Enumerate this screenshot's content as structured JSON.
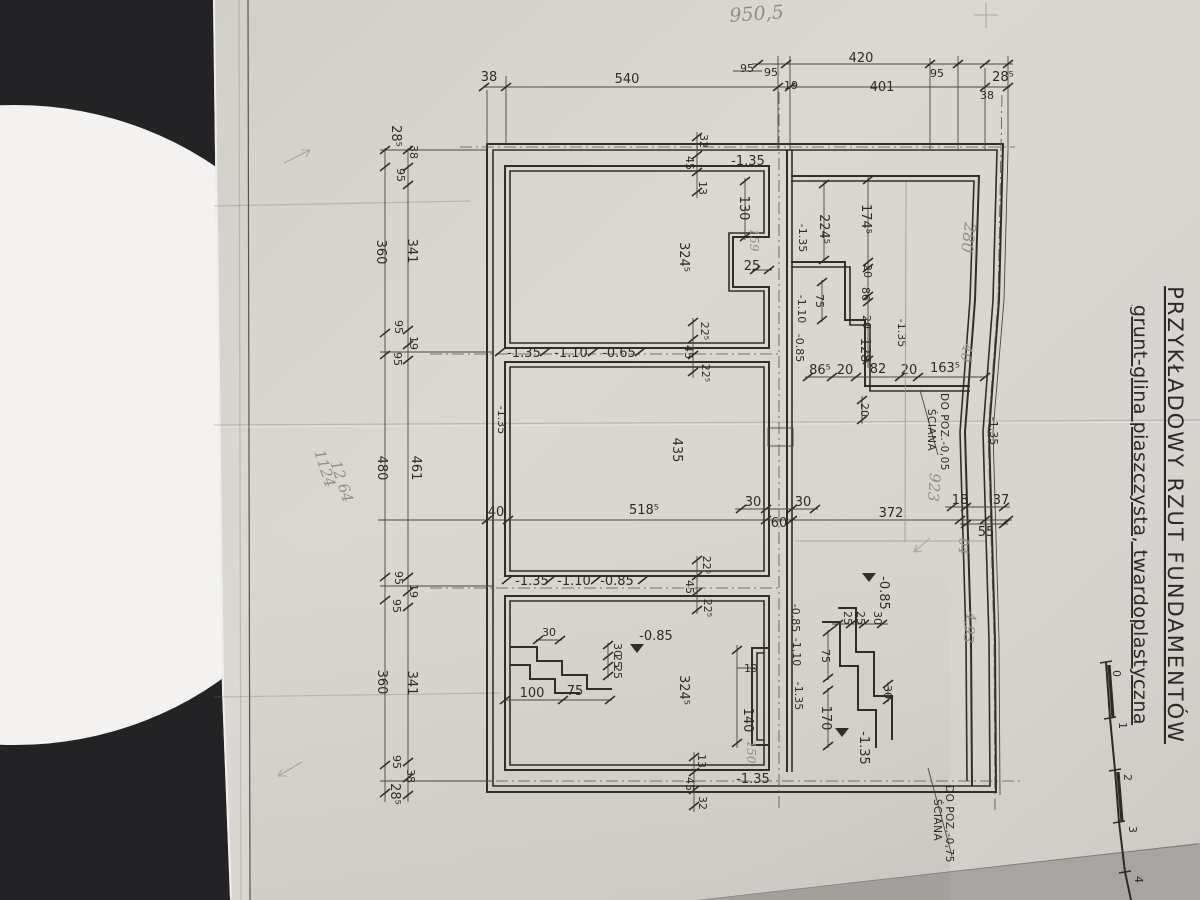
{
  "photo": {
    "background": "#232325",
    "table": "#f3f2f0",
    "paper": "#d8d5d0",
    "floor_bottom_right": "#a7a5a1",
    "ink": "#312e29",
    "pencil": "#918d85"
  },
  "title": {
    "line1": "PRZYKŁADOWY  RZUT  FUNDAMENTÓW",
    "line2": "grunt-glina piaszczysta, twardoplastyczna"
  },
  "notes": {
    "wall_mid_1": "ŚCIANA",
    "wall_mid_2": "DO POZ.-0,05",
    "wall_bot_1": "ŚCIANA",
    "wall_bot_2": "DO POZ.-0,75"
  },
  "scale": [
    "0",
    "1",
    "2",
    "3",
    "4"
  ],
  "dims": {
    "top": [
      "38",
      "540",
      "95",
      "95",
      "19",
      "420",
      "401",
      "95",
      "38",
      "28⁵"
    ],
    "left": [
      "28⁵",
      "38",
      "95",
      "360",
      "341",
      "95",
      "19",
      "95",
      "480",
      "461",
      "95",
      "19",
      "95",
      "360",
      "341",
      "95",
      "38",
      "28⁵"
    ],
    "mid": [
      "40",
      "518⁵",
      "30",
      "60",
      "30",
      "372",
      "18",
      "55",
      "37"
    ],
    "room1": [
      "32",
      "45",
      "13",
      "-1.35",
      "130",
      "25",
      "324⁵",
      "22⁵",
      "45",
      "22⁵"
    ],
    "band1": [
      "-1.35",
      "-1.10",
      "-0.65"
    ],
    "cwall_up": [
      "224⁵",
      "-1.35",
      "75",
      "-1.10",
      "-0.85"
    ],
    "right_up": [
      "174⁵",
      "20",
      "86",
      "20",
      "128",
      "-1.35",
      "86⁵",
      "20",
      "82",
      "20",
      "163⁵",
      "20"
    ],
    "mid_area": [
      "435",
      "-1.35",
      "-1.35"
    ],
    "band2": [
      "-1.35",
      "-1.10",
      "-0.85",
      "45",
      "22⁵",
      "22⁵"
    ],
    "room3": [
      "30",
      "-0.85",
      "30",
      "25",
      "25",
      "100",
      "75",
      "324⁵",
      "13",
      "45",
      "32",
      "-1.35",
      "19",
      "140"
    ],
    "cwall_dn": [
      "-0.85",
      "-1.10",
      "-1.35"
    ],
    "stairs_r": [
      "-0.85",
      "25",
      "25",
      "30",
      "75",
      "30",
      "170",
      "-1.35"
    ]
  },
  "handwritten": {
    "top": "950,5",
    "r1": "280",
    "r2": "40",
    "r3": "923",
    "r4": "04",
    "r5": "4,93",
    "l1": "1124",
    "l2": "12 64",
    "s1": "159",
    "s2": "150"
  }
}
